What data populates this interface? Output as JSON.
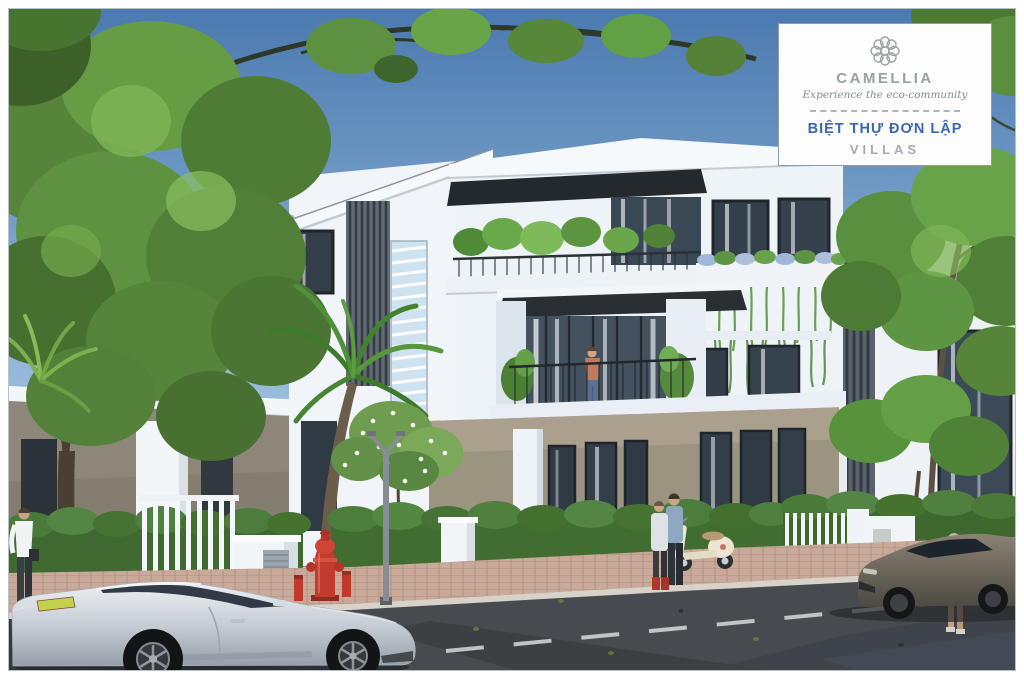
{
  "badge_card": {
    "brand": "CAMELLIA",
    "tagline": "Experience the eco-community",
    "title_vi": "BIỆT THỰ ĐƠN LẬP",
    "title_en": "VILLAS"
  },
  "colors": {
    "brand_blue": "#3a67ae",
    "brand_gray": "#99a39d",
    "card_background": "#fdfdfe",
    "sky_top": "#4b7ab0",
    "sky_horizon": "#c8dcea",
    "foliage_green": "#5f9243",
    "villa_white": "#f1f5f9",
    "ground_floor_taupe": "#9b9480",
    "road_asphalt": "#474a4e",
    "sidewalk_brick": "#c9a99a",
    "hydrant_red": "#c23b2e",
    "car_silver": "#c3cad2"
  }
}
